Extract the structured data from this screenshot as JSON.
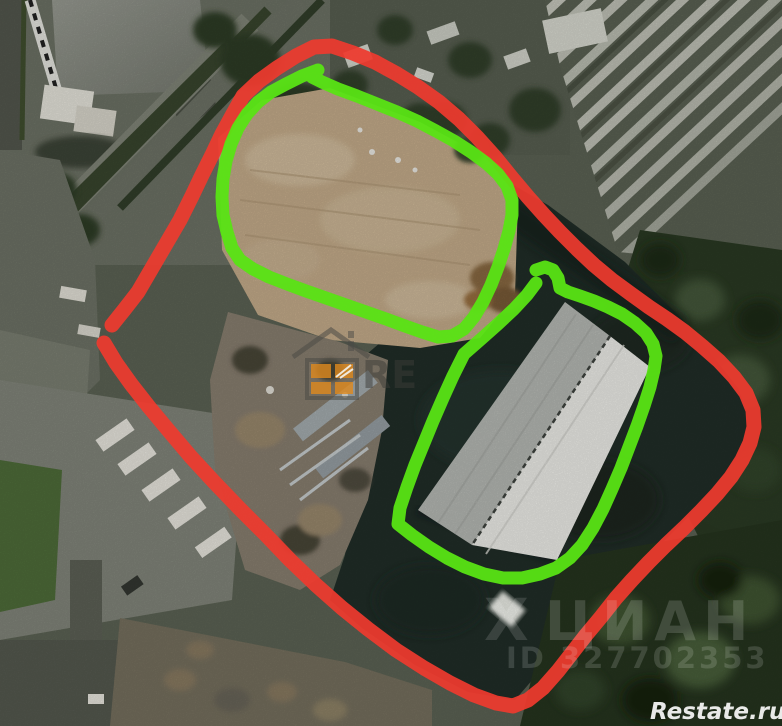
{
  "annotations": {
    "red_color": "#ee3a2e",
    "green_color": "#58e414"
  },
  "watermarks": {
    "cian_logo_glyph": "Х",
    "cian_text": "ЦИАН",
    "listing_id": "ID 327702353",
    "restate_url": "Restate.ru",
    "restate_logo_text": "RE",
    "window_pane_color": "#e08a1e"
  }
}
